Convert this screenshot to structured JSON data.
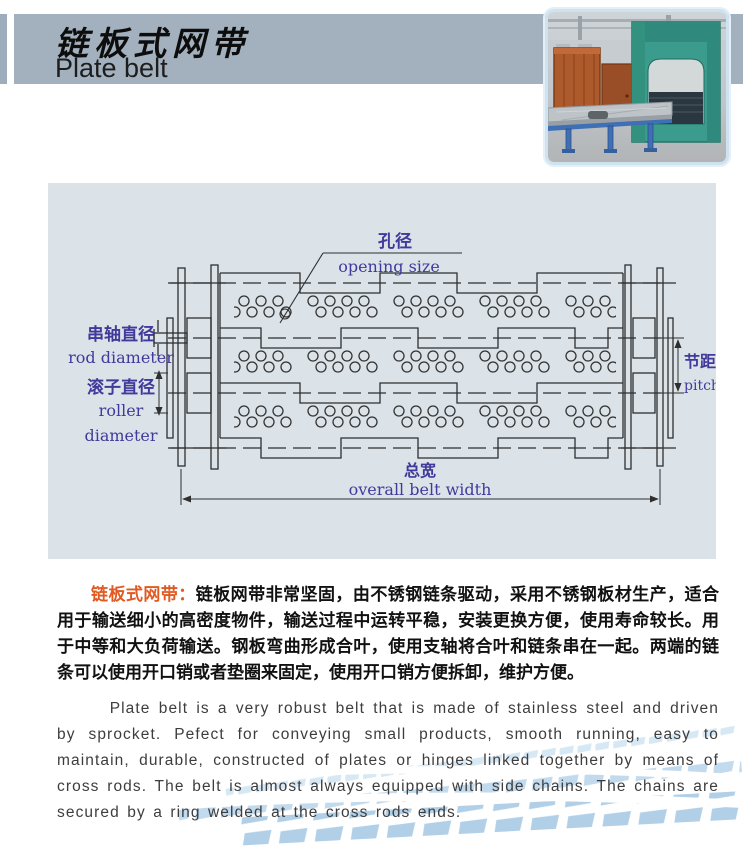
{
  "header": {
    "title_zh": "链板式网带",
    "title_en": "Plate belt"
  },
  "diagram": {
    "labels": {
      "opening_size_zh": "孔径",
      "opening_size_en": "opening size",
      "rod_diameter_zh": "串轴直径",
      "rod_diameter_en": "rod diameter",
      "roller_diameter_zh": "滚子直径",
      "roller_diameter_en1": "roller",
      "roller_diameter_en2": "diameter",
      "pitch_zh": "节距",
      "pitch_en": "pitch",
      "overall_width_zh": "总宽",
      "overall_width_en": "overall belt width"
    }
  },
  "description": {
    "zh_lead": "链板式网带：",
    "zh_body": "链板网带非常坚固，由不锈钢链条驱动，采用不锈钢板材生产，适合用于输送细小的高密度物件，输送过程中运转平稳，安装更换方便，使用寿命较长。用于中等和大负荷输送。钢板弯曲形成合叶，使用支轴将合叶和链条串在一起。两端的链条可以使用开口销或者垫圈来固定，使用开口销方便拆卸，维护方便。",
    "en_body": "Plate belt is a very robust belt that is made of stainless steel and driven by sprocket. Pefect for conveying small products, smooth running, easy to maintain, durable, constructed of plates or hinges linked together by means of cross rods. The belt is almost always equipped with side chains. The chains are secured by a ring welded at the cross rods ends."
  },
  "colors": {
    "header_bar": "#a3b1be",
    "panel_bg": "#dbe3e9",
    "diagram_label": "#43399b",
    "lead_in_orange": "#e05a22",
    "deco_tile_blue": "#b7d4ea"
  }
}
